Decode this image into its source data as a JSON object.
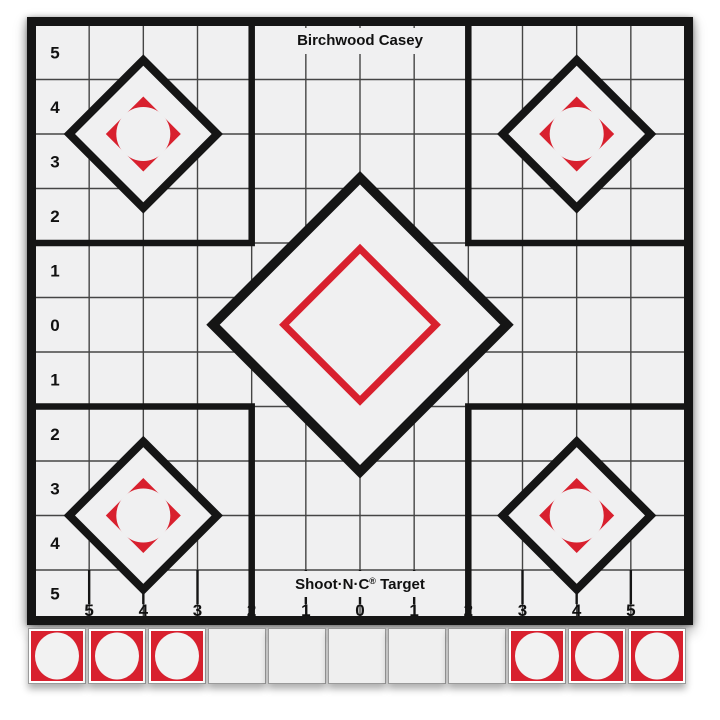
{
  "target_sheet": {
    "brand_title": "Birchwood Casey",
    "product_brand": "Shoot·N·C",
    "registered_mark": "®",
    "product_suffix": " Target"
  },
  "grid_axes": {
    "left_labels": [
      "5",
      "4",
      "3",
      "2",
      "1",
      "0",
      "1",
      "2",
      "3",
      "4",
      "5"
    ],
    "bottom_labels": [
      "5",
      "4",
      "3",
      "2",
      "1",
      "0",
      "1",
      "2",
      "3",
      "4",
      "5"
    ]
  },
  "colors": {
    "bullseye_red": "#d8202e",
    "ink_black": "#151515",
    "paper_gray": "#f0f0f1",
    "grid_line": "#454545"
  },
  "paster_strip": {
    "squares": [
      "filled",
      "filled",
      "filled",
      "blank",
      "blank",
      "blank",
      "blank",
      "blank",
      "filled",
      "filled",
      "filled"
    ]
  }
}
